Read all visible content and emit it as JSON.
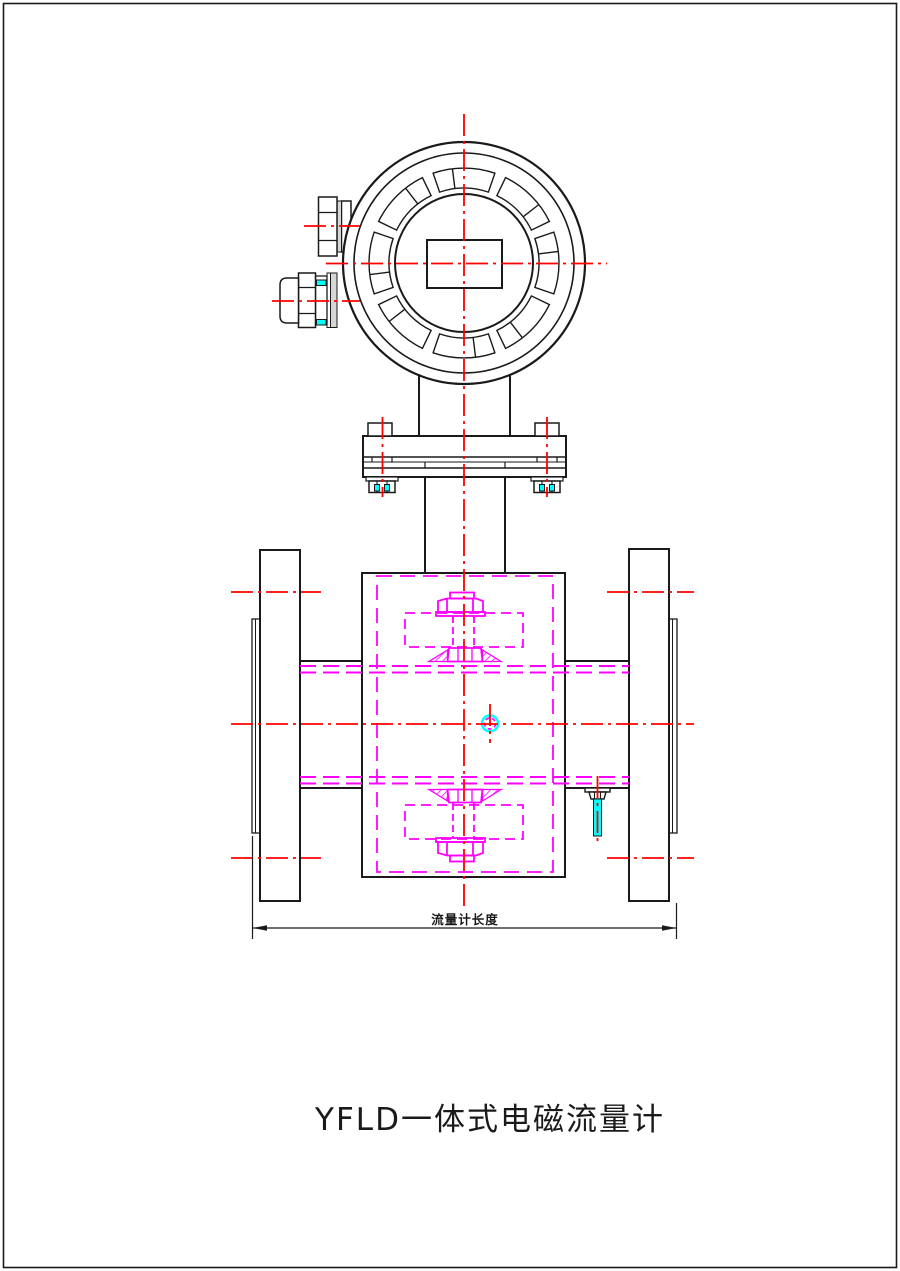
{
  "drawing": {
    "title": "YFLD一体式电磁流量计",
    "dimension_label": "流量计长度"
  },
  "colors": {
    "line-black": "#1a1a1a",
    "centerline-red": "#ff0000",
    "detail-magenta": "#ff00ff",
    "highlight-cyan": "#00ffff",
    "boss-gray": "#d6d6d6",
    "paper-white": "#ffffff"
  }
}
